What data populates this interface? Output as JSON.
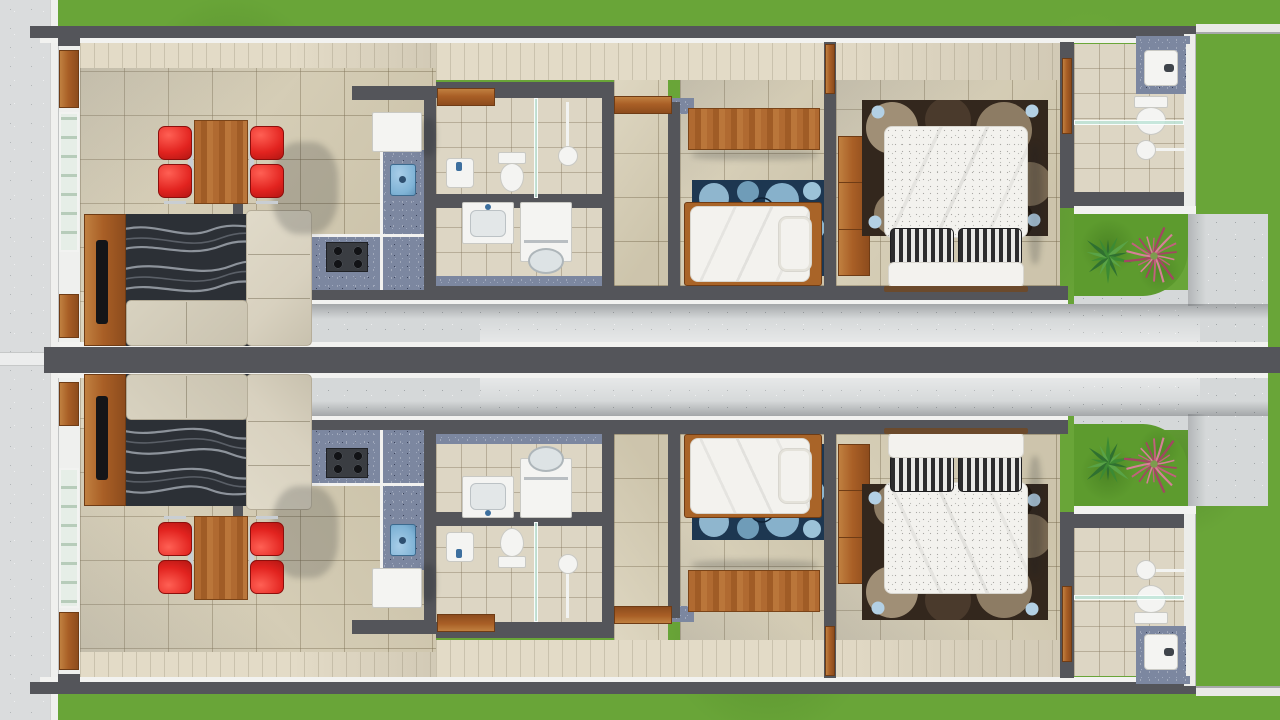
{
  "scene": {
    "description": "Top-down 3D architectural rendering of two mirrored narrow twin houses that share a central dividing wall. Each unit has a living-dining room, kitchen, bathroom, laundry area, hallway, single bedroom, master bedroom, en-suite bathroom, side corridor, rear garden and concrete patio. A sidewalk runs along the left edge and lawns border the top, bottom and right edges.",
    "units": [
      {
        "id": "house-unit-top",
        "label": "Top house unit",
        "mirrored": false
      },
      {
        "id": "house-unit-bottom",
        "label": "Bottom house unit (mirror copy)",
        "mirrored": true
      }
    ],
    "rooms": [
      {
        "id": "living-dining-room",
        "furniture": [
          "tv-sideboard",
          "flat-tv",
          "wave-pattern-rug",
          "l-shaped-sofa",
          "wood-dining-table",
          "red-dining-chair",
          "red-dining-chair",
          "red-dining-chair",
          "red-dining-chair"
        ]
      },
      {
        "id": "kitchen",
        "furniture": [
          "refrigerator",
          "granite-l-counter",
          "blue-inset-sink",
          "four-burner-cooktop"
        ]
      },
      {
        "id": "bathroom",
        "furniture": [
          "washbasin",
          "toilet",
          "shower-head",
          "glass-partition",
          "open-wood-door"
        ]
      },
      {
        "id": "laundry-area",
        "furniture": [
          "washtub",
          "washing-machine",
          "laundry-basket"
        ]
      },
      {
        "id": "hallway",
        "furniture": [
          "open-wood-door"
        ]
      },
      {
        "id": "bedroom-single",
        "furniture": [
          "wood-desk",
          "blue-circle-rug",
          "single-bed",
          "pillow"
        ]
      },
      {
        "id": "bedroom-master",
        "furniture": [
          "wood-wardrobe",
          "brown-circle-rug",
          "double-bed",
          "striped-pillow",
          "striped-pillow",
          "wood-headboard"
        ]
      },
      {
        "id": "ensuite-bathroom",
        "furniture": [
          "granite-vanity",
          "washbasin",
          "toilet",
          "glass-partition",
          "shower-head",
          "open-wood-door"
        ]
      },
      {
        "id": "garden",
        "furniture": [
          "agave-plant",
          "pink-foliage-plant"
        ]
      },
      {
        "id": "side-corridor",
        "furniture": []
      },
      {
        "id": "rear-patio",
        "furniture": []
      }
    ],
    "exterior": [
      "front-sidewalk",
      "lawn-top-strip",
      "lawn-bottom-strip",
      "backyard-lawn",
      "property-dividing-wall",
      "front-doors",
      "front-windows"
    ]
  },
  "colors": {
    "grass": "#69a538",
    "garden_grass": "#5d9b2e",
    "sidewalk": "#dadcdd",
    "concrete": "#d5d8d9",
    "wall": "#54555a",
    "wall_white": "#f2f2f0",
    "wallface": "#e3dbc7",
    "floor_tile": "#d8cfb5",
    "tile_small": "#ddd6c4",
    "granite": "#7c87a0",
    "wood": "#a95f26",
    "glass": "#cfe4d6",
    "shower_glass": "#bee4d8",
    "rug_living": "#2c3036",
    "rug_wave": "#989ea6",
    "sofa": "#d8d1bf",
    "chair_red": "#e2231f",
    "table_wood": "#b06a31",
    "rug_bedroom1": "#1d3751",
    "rug_bedroom1_circle": "#8fb6ce",
    "rug_master": "#33271d",
    "rug_master_circle": "#a08f76",
    "rug_dot_blue": "#b3d0e4",
    "bed_white": "#f3f2ee",
    "pillow_dark": "#2c2c2e",
    "appliance": "#f4f4f2",
    "sink_blue": "#7fb3d6",
    "plant_green": "#3c8a33",
    "plant_pink": "#c2607e",
    "tv_black": "#141518",
    "chrome": "#c9ced3"
  }
}
